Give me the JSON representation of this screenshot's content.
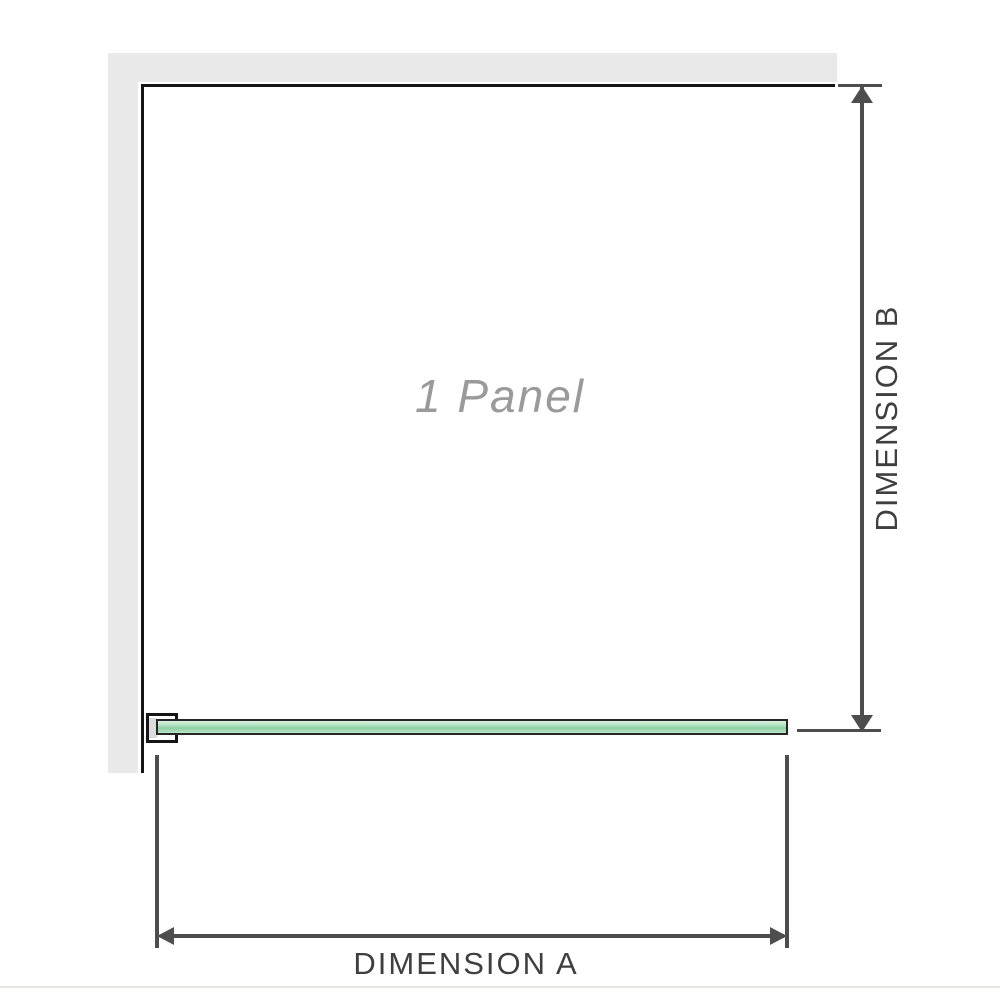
{
  "diagram": {
    "panel_label": "1 Panel",
    "dimension_a": {
      "label": "DIMENSION A"
    },
    "dimension_b": {
      "label": "DIMENSION B"
    }
  },
  "colors": {
    "background": "#ffffff",
    "wall_fill": "#e9e9e9",
    "panel_outline": "#151515",
    "dimension_line": "#4d4d4d",
    "dimension_text": "#3f3f3f",
    "glass_green": "#9fd6ae",
    "glass_border": "#262626",
    "panel_label_gray": "#9a9a9a"
  }
}
